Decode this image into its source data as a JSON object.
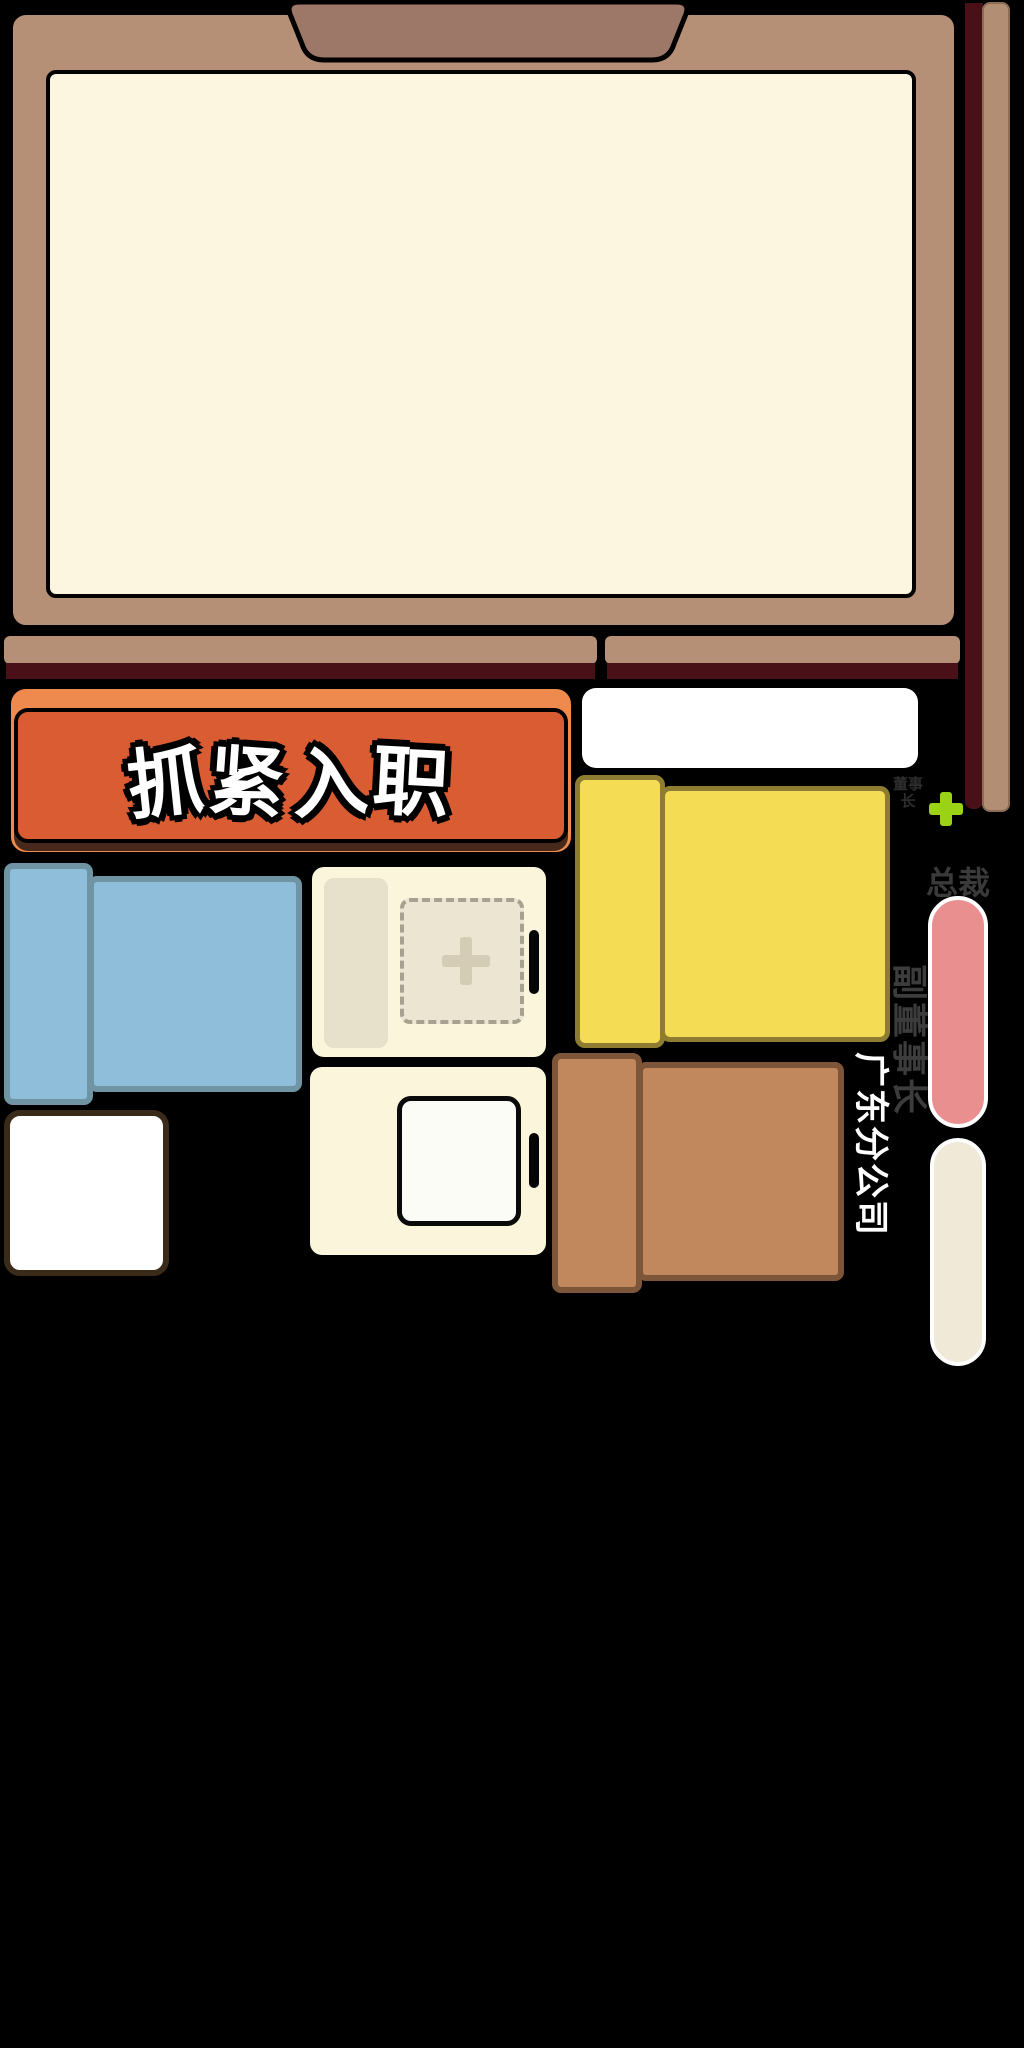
{
  "game": {
    "cta_button": {
      "label": "抓紧入职"
    },
    "career_ladder": {
      "locked_top_label": "董事长",
      "ceo_label": "总裁",
      "vice_chairman_label": "副董事长",
      "branch_label": "广东分公司"
    },
    "icons": {
      "add_icon": "green-plus",
      "empty_slot_icon": "dashed-plus-slot"
    },
    "colors": {
      "background": "#000000",
      "board_frame": "#B59076",
      "board_clip": "#9D7767",
      "board_surface": "#FCF5E0",
      "shelf_shadow": "#4A1018",
      "cta_orange": "#D95C33",
      "cta_orange_light": "#EF8A4E",
      "piece_yellow": "#F5DC55",
      "piece_blue": "#8FBEDA",
      "piece_brown": "#C0885C",
      "pill_pink": "#E98F8F",
      "pill_cream": "#F0E9D8",
      "plus_green": "#9CD215"
    }
  }
}
